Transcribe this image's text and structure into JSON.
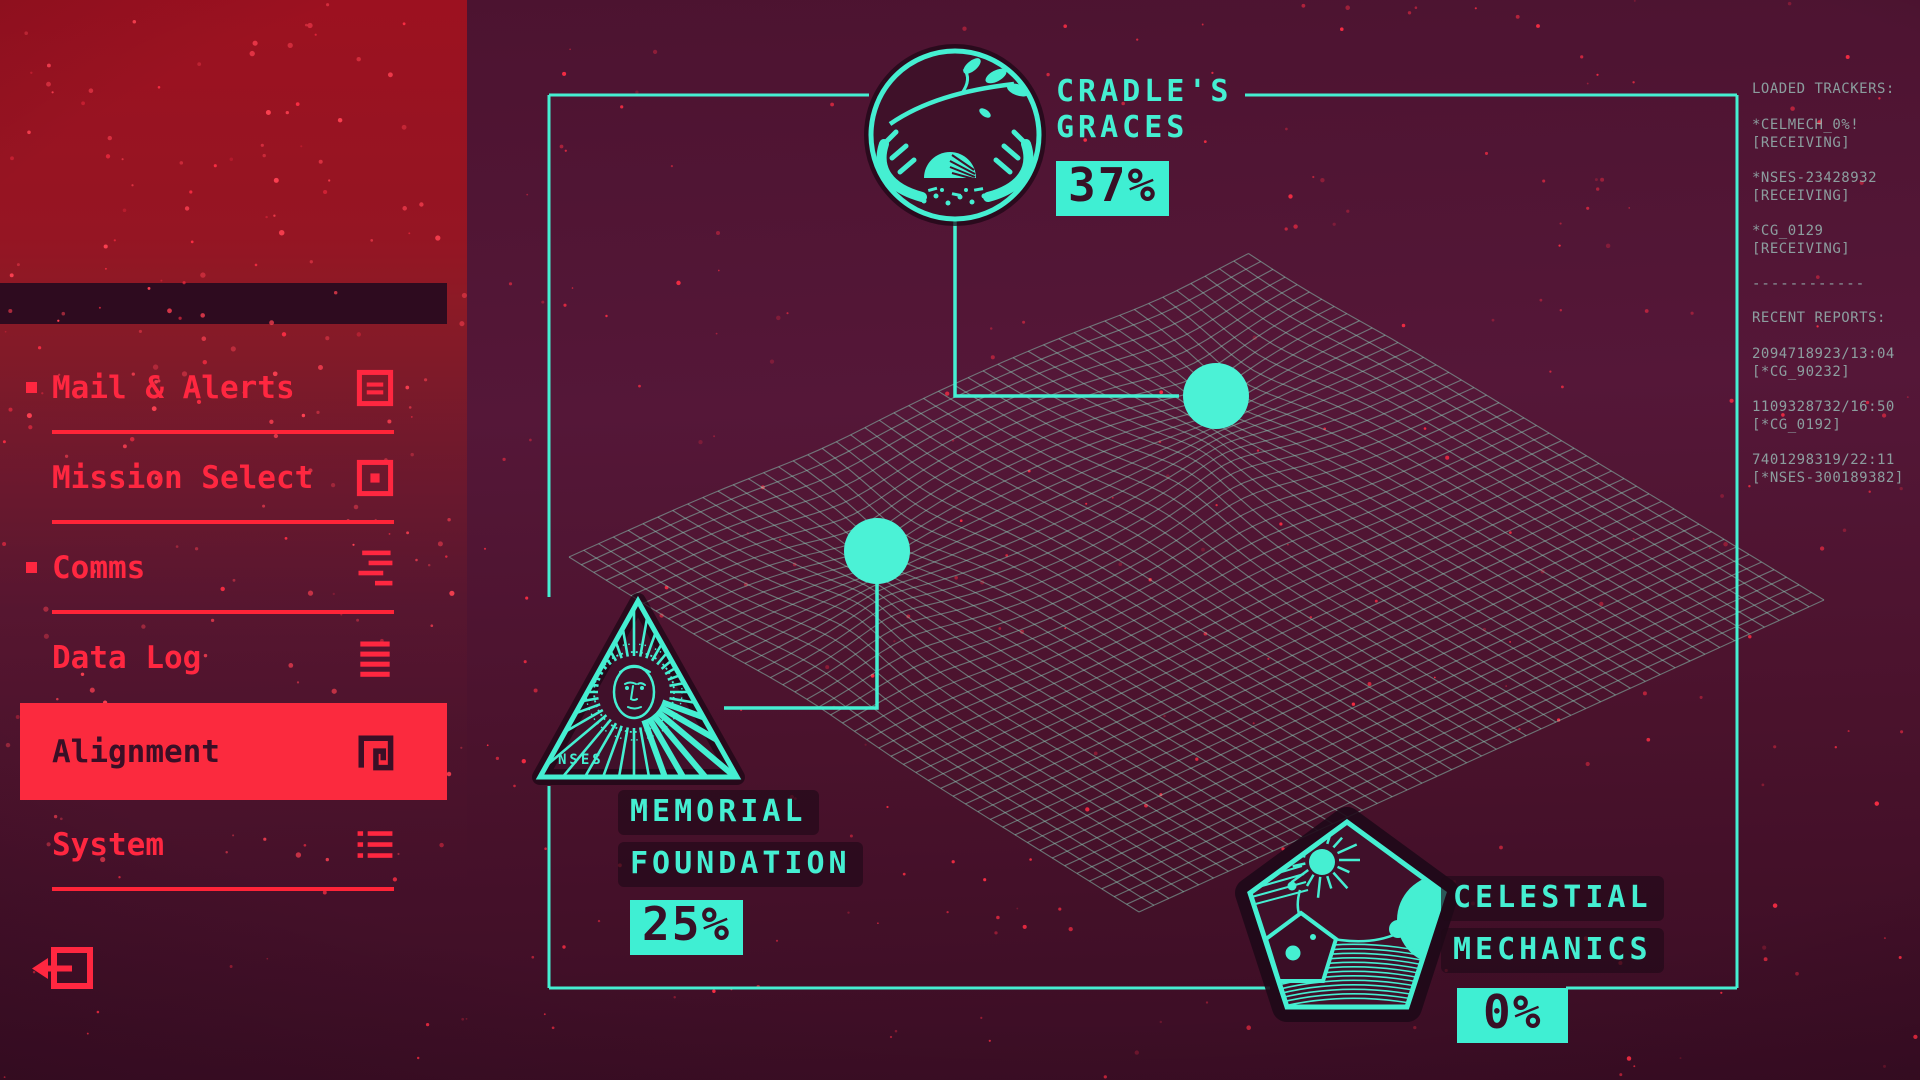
{
  "screen": "Alignment",
  "colors": {
    "teal": "#45efd2",
    "menu_red": "#ff2740",
    "selected_bg": "#fb2a3e",
    "selected_text": "#3a0f26",
    "badge_bg": "#3fefd3",
    "badge_text": "#381026"
  },
  "sidebar": {
    "items": [
      {
        "label": "Mail & Alerts",
        "icon": "mail-icon",
        "bullet": true,
        "selected": false
      },
      {
        "label": "Mission Select",
        "icon": "mission-icon",
        "bullet": false,
        "selected": false
      },
      {
        "label": "Comms",
        "icon": "comms-icon",
        "bullet": true,
        "selected": false
      },
      {
        "label": "Data Log",
        "icon": "datalog-icon",
        "bullet": false,
        "selected": false
      },
      {
        "label": "Alignment",
        "icon": "alignment-icon",
        "bullet": false,
        "selected": true
      },
      {
        "label": "System",
        "icon": "system-icon",
        "bullet": false,
        "selected": false
      }
    ],
    "exit": {
      "icon": "logout-icon"
    }
  },
  "tracker_panel": {
    "loaded_title": "LOADED TRACKERS:",
    "trackers": [
      {
        "id": "*CELMECH_0%!",
        "status": "[RECEIVING]"
      },
      {
        "id": "*NSES-23428932",
        "status": "[RECEIVING]"
      },
      {
        "id": "*CG_0129",
        "status": "[RECEIVING]"
      }
    ],
    "divider": "------------",
    "reports_title": "RECENT REPORTS:",
    "reports": [
      {
        "id": "2094718923/13:04",
        "source": "[*CG_90232]"
      },
      {
        "id": "1109328732/16:50",
        "source": "[*CG_0192]"
      },
      {
        "id": "7401298319/22:11",
        "source": "[*NSES-300189382]"
      }
    ]
  },
  "factions": [
    {
      "name": "Cradle's Graces",
      "name_lines": [
        "CRADLE'S",
        "GRACES"
      ],
      "percent": 37,
      "percent_label": "37%",
      "emblem": "cradle-emblem"
    },
    {
      "name": "Memorial Foundation",
      "name_lines": [
        "MEMORIAL",
        "FOUNDATION"
      ],
      "percent": 25,
      "percent_label": "25%",
      "emblem": "memorial-emblem",
      "emblem_text": "NSES"
    },
    {
      "name": "Celestial Mechanics",
      "name_lines": [
        "CELESTIAL",
        "MECHANICS"
      ],
      "percent": 0,
      "percent_label": "0%",
      "emblem": "celestial-emblem"
    }
  ]
}
